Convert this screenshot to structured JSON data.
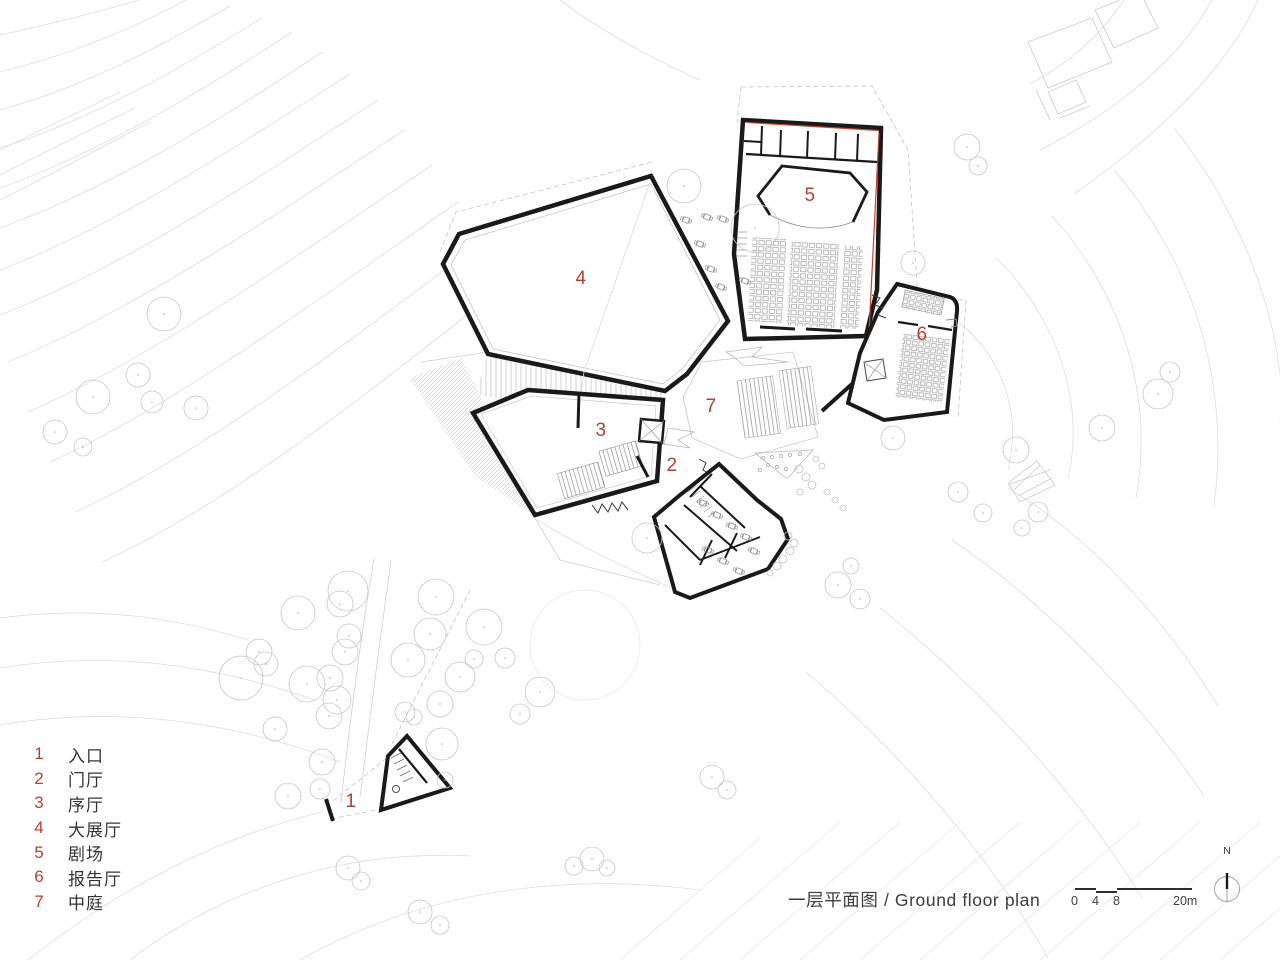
{
  "palette": {
    "marker": "#b2432f",
    "wall": "#1a1a1a",
    "accent_red": "#c0462e",
    "contour": "#dedede"
  },
  "legend": {
    "items": [
      {
        "num": "1",
        "label": "入口"
      },
      {
        "num": "2",
        "label": "门厅"
      },
      {
        "num": "3",
        "label": "序厅"
      },
      {
        "num": "4",
        "label": "大展厅"
      },
      {
        "num": "5",
        "label": "剧场"
      },
      {
        "num": "6",
        "label": "报告厅"
      },
      {
        "num": "7",
        "label": "中庭"
      }
    ]
  },
  "plan": {
    "markers": [
      {
        "label": "1"
      },
      {
        "label": "2"
      },
      {
        "label": "3"
      },
      {
        "label": "4"
      },
      {
        "label": "5"
      },
      {
        "label": "6"
      },
      {
        "label": "7"
      }
    ]
  },
  "footer": {
    "title": "一层平面图 / Ground floor plan"
  },
  "scalebar": {
    "ticks": [
      "0",
      "4",
      "8",
      "20m"
    ]
  },
  "north": {
    "label": "N"
  }
}
